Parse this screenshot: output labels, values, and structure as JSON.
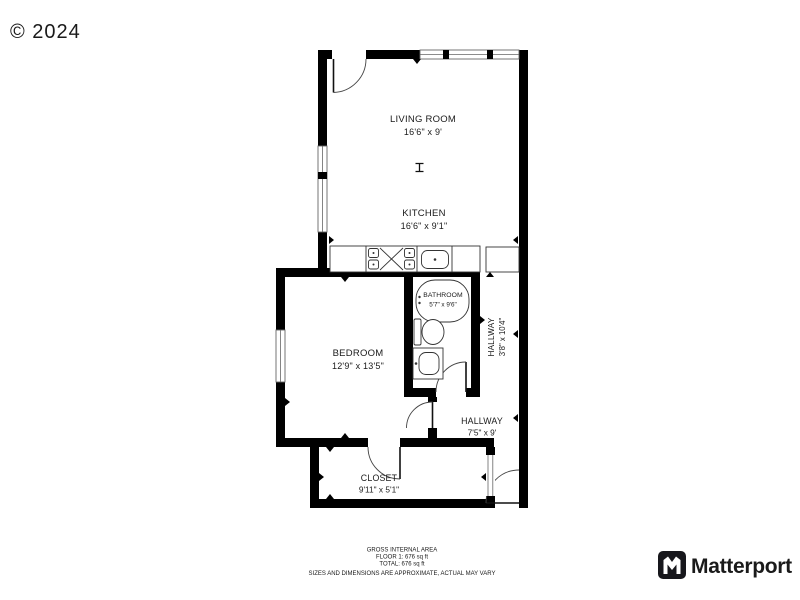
{
  "watermark": "© 2024",
  "rooms": {
    "living_room": {
      "name": "LIVING ROOM",
      "dims": "16'6\" x 9'"
    },
    "kitchen": {
      "name": "KITCHEN",
      "dims": "16'6\" x 9'1\""
    },
    "bathroom": {
      "name": "BATHROOM",
      "dims": "5'7\" x 9'6\""
    },
    "bedroom": {
      "name": "BEDROOM",
      "dims": "12'9\" x 13'5\""
    },
    "hallway_upper": {
      "name": "HALLWAY",
      "dims": "3'8\" x 10'4\""
    },
    "hallway_lower": {
      "name": "HALLWAY",
      "dims": "7'5\" x 9'"
    },
    "closet": {
      "name": "CLOSET",
      "dims": "9'11\" x 5'1\""
    }
  },
  "footer": {
    "title": "GROSS INTERNAL AREA",
    "floor_area": "FLOOR 1: 676 sq ft",
    "total_area": "TOTAL: 676 sq ft",
    "disclaimer": "SIZES AND DIMENSIONS ARE APPROXIMATE, ACTUAL MAY VARY"
  },
  "branding": {
    "name": "Matterport"
  },
  "colors": {
    "wall": "#000000",
    "background": "#ffffff",
    "label": "#1a1a1a",
    "watermark": "#9e9e9e",
    "disclaimer": "#bcbcbc",
    "logo": "#303038"
  }
}
